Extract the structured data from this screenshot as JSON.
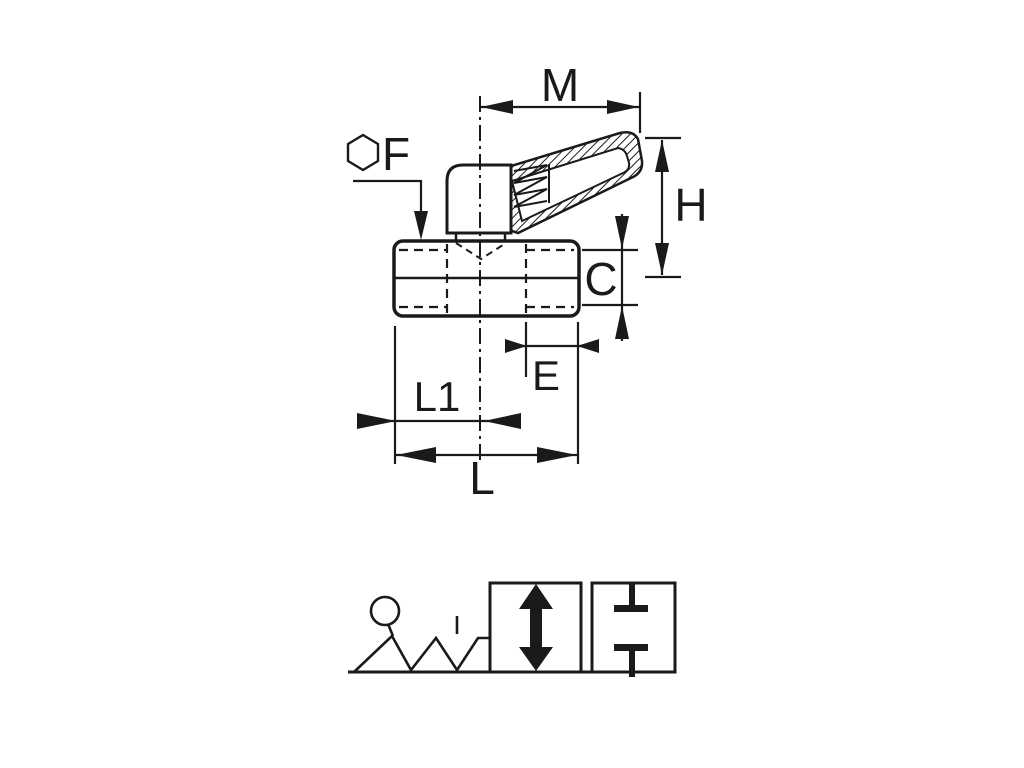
{
  "meta": {
    "background_color": "#ffffff",
    "line_color": "#1a1a1a",
    "figure": "technical-dimension-drawing-with-valve-schematic"
  },
  "labels": {
    "m": "M",
    "f": "F",
    "h": "H",
    "c": "C",
    "e": "E",
    "l1": "L1",
    "l": "L"
  }
}
